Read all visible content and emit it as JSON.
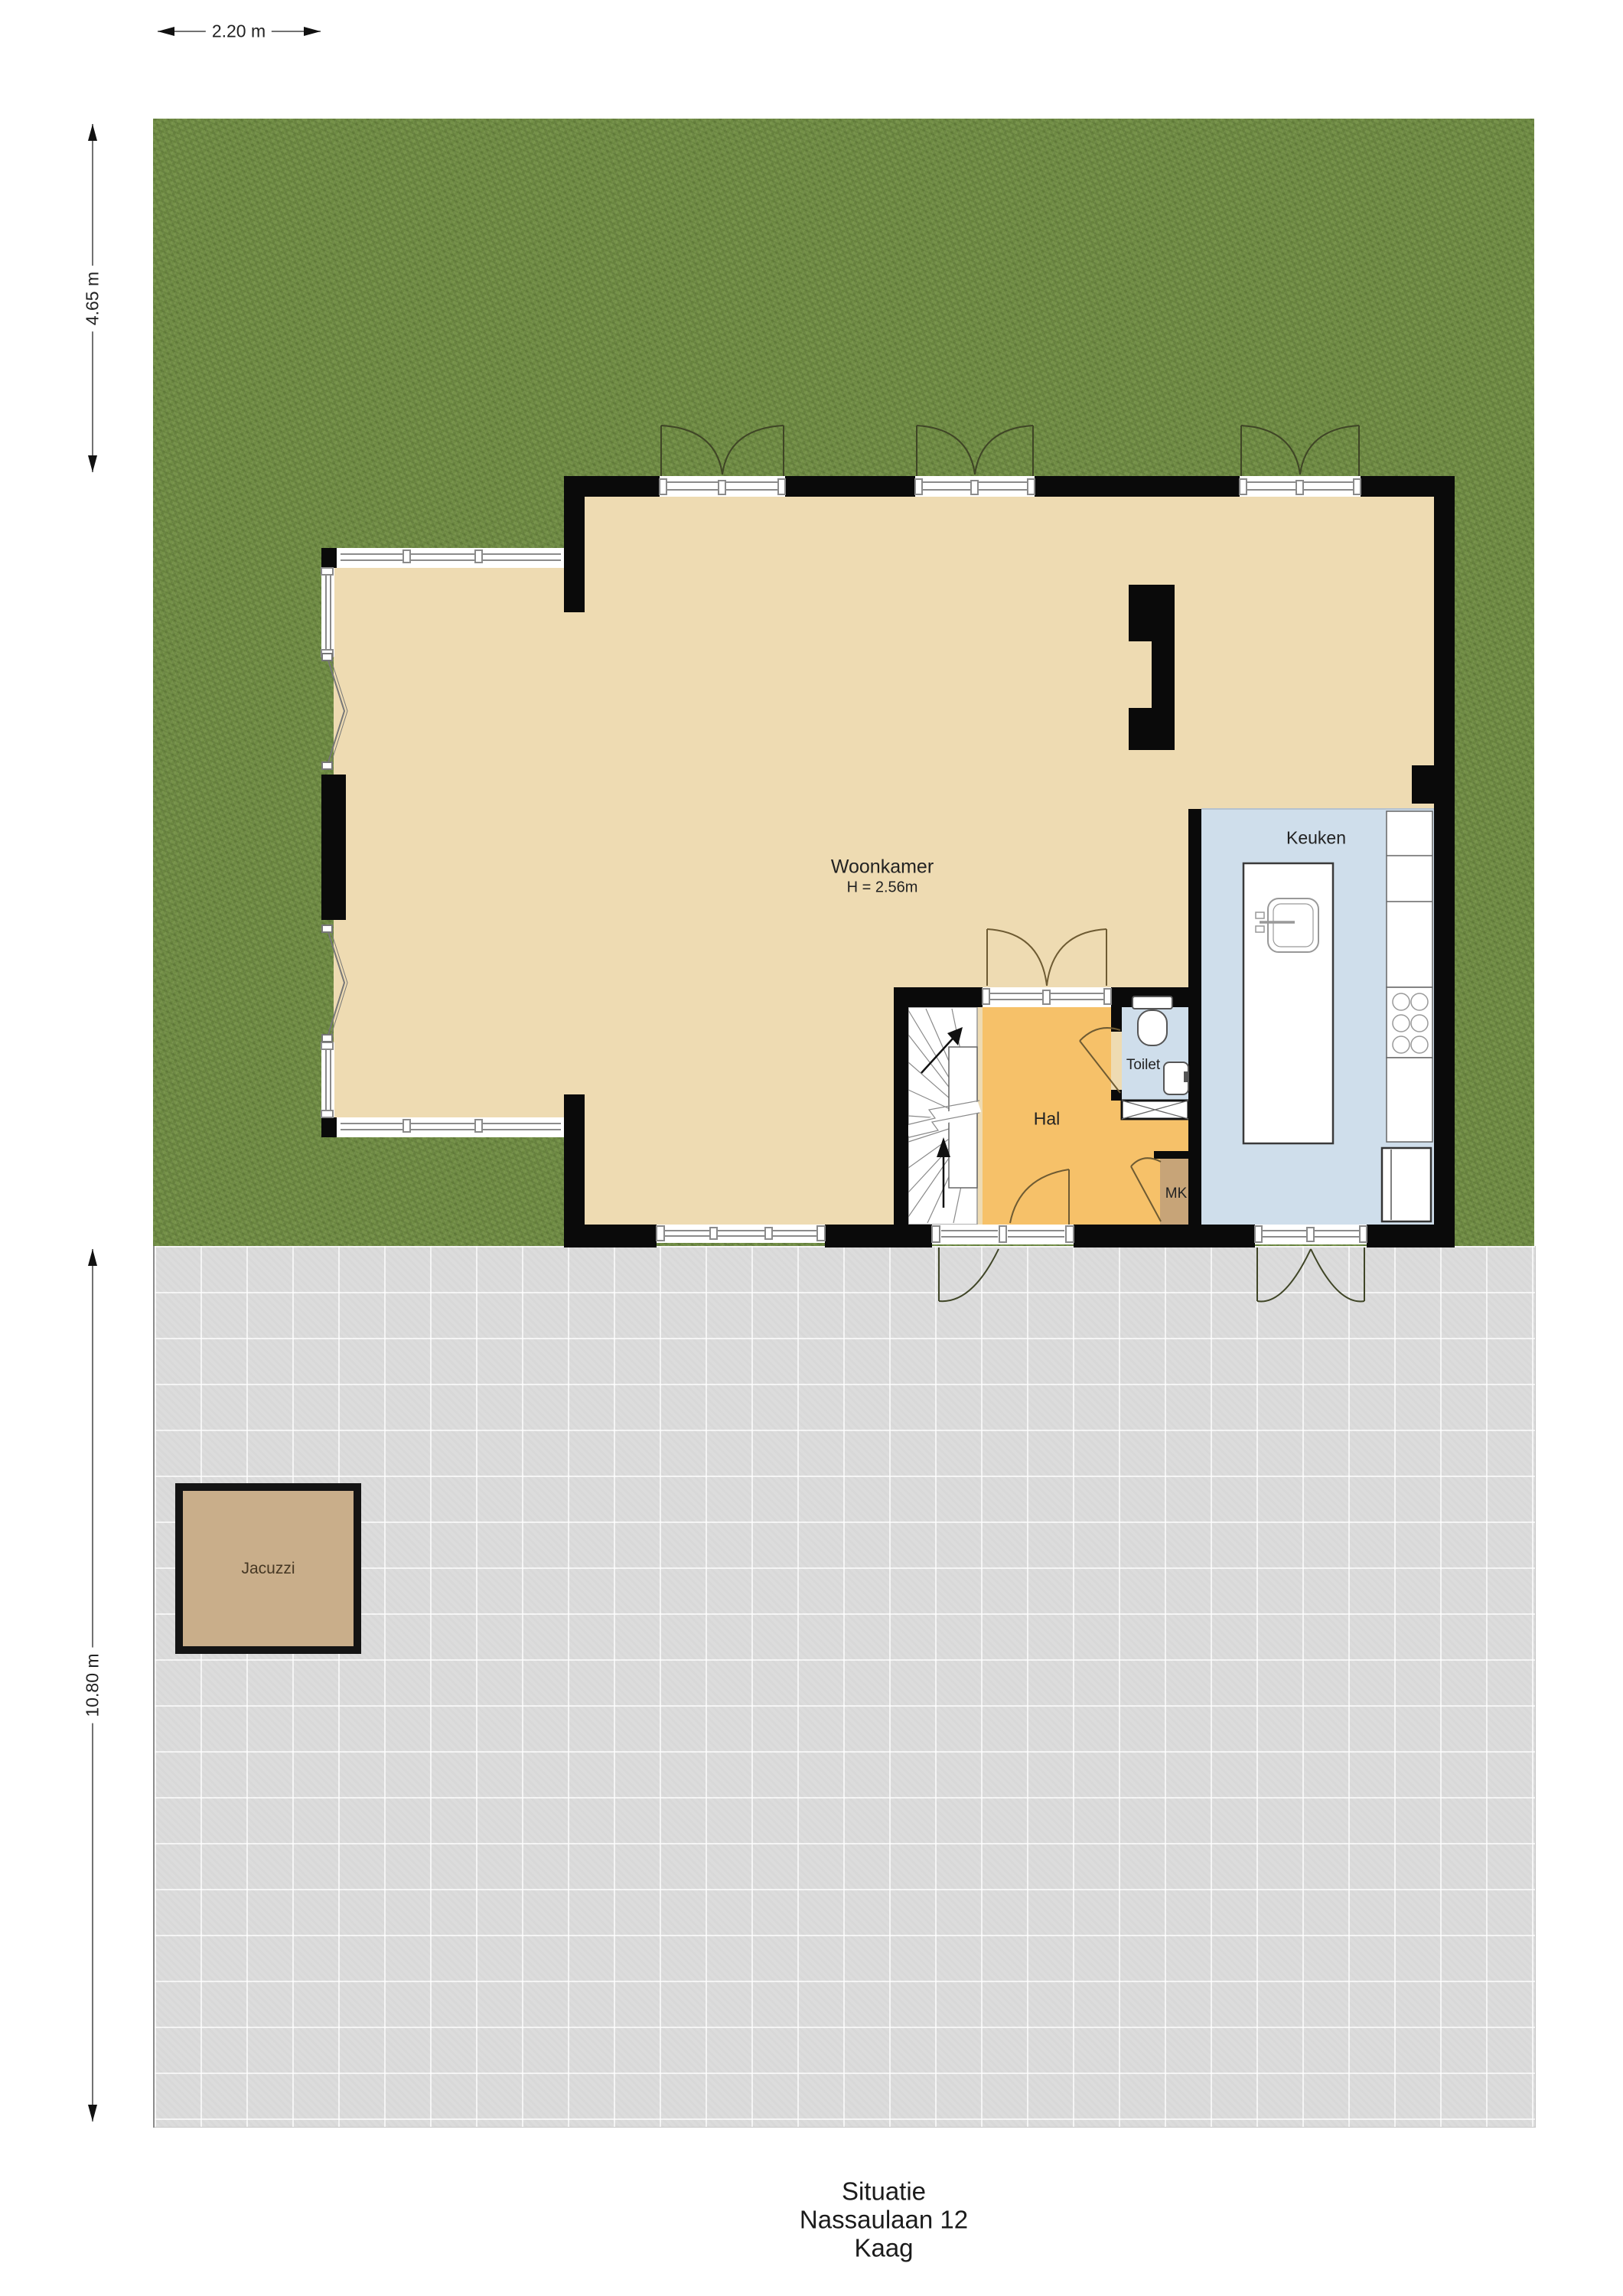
{
  "title": {
    "caption_line1": "Situatie",
    "caption_line2": "Nassaulaan 12",
    "caption_line3": "Kaag"
  },
  "dimensions": {
    "top_width": "2.20 m",
    "garden_depth": "4.65 m",
    "terrace_depth": "10.80 m"
  },
  "rooms": {
    "woonkamer": {
      "label": "Woonkamer",
      "ceiling_note": "H = 2.56m",
      "floor": "#eedbb2"
    },
    "keuken": {
      "label": "Keuken",
      "floor": "#cfdeeb"
    },
    "hal": {
      "label": "Hal",
      "floor": "#f6c169"
    },
    "toilet": {
      "label": "Toilet",
      "floor": "#cfdeeb"
    },
    "mk": {
      "label": "MK",
      "floor": "#c7a478"
    }
  },
  "outdoor": {
    "jacuzzi": {
      "label": "Jacuzzi",
      "fill": "#c9ae8a"
    },
    "grass_color": "#75914b",
    "terrace_color": "#dcdcdc"
  },
  "colors": {
    "wall": "#0a0a0a",
    "window_frame": "#8b8b8b",
    "door_swing_exterior": "#3f4526",
    "door_swing_interior": "#6e5b33",
    "fixture_stroke": "#555555",
    "stair_lines": "#8a8a8a",
    "dimension_line": "#444444",
    "text": "#222222"
  }
}
